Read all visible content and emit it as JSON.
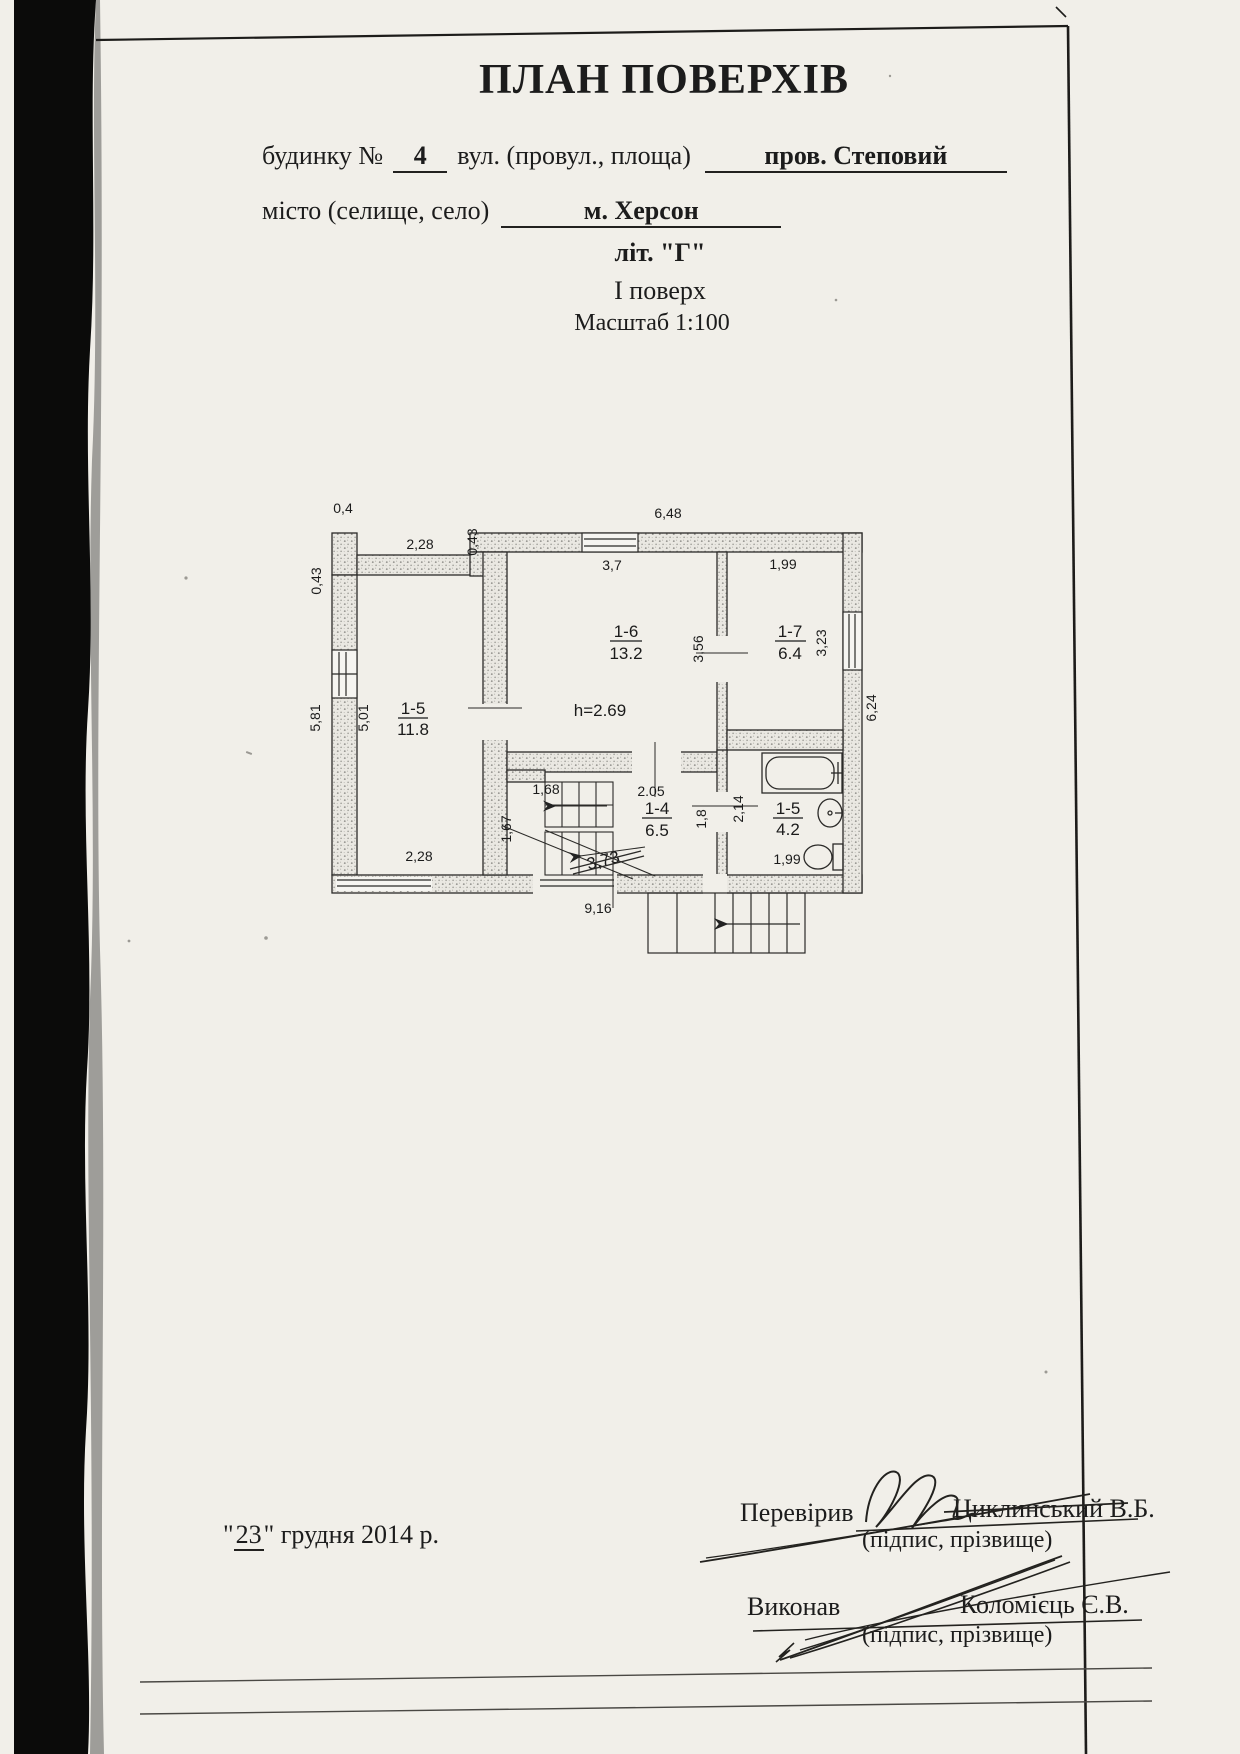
{
  "header": {
    "title": "ПЛАН ПОВЕРХІВ",
    "form_line1": {
      "label1": "будинку №",
      "value1": "4",
      "label2": "вул. (провул., площа)",
      "value2": "пров. Степовий"
    },
    "form_line2": {
      "label": "місто (селище, село)",
      "value": "м. Херсон"
    },
    "liter": "літ. \"Г\"",
    "floor_label": "І поверх",
    "scale_label": "Масштаб 1:100"
  },
  "plan": {
    "rooms": {
      "r15": {
        "id": "1-5",
        "area": "11.8"
      },
      "r16": {
        "id": "1-6",
        "area": "13.2"
      },
      "r17": {
        "id": "1-7",
        "area": "6.4"
      },
      "r14": {
        "id": "1-4",
        "area": "6.5"
      },
      "r15b": {
        "id": "1-5",
        "area": "4.2"
      }
    },
    "ceiling_height": "h=2.69",
    "stair_note_crossed": "3,73",
    "dims": {
      "pier_width": "0,4",
      "left_top_wall": "2,28",
      "top_offset": "0,43",
      "top_width": "6,48",
      "top_window": "3,7",
      "r17_width": "1,99",
      "left_wall_upper": "0,43",
      "left_outer": "5,81",
      "left_inner": "5,01",
      "r16_depth": "3,56",
      "r17_window": "3,23",
      "right_outer": "6,24",
      "r15_bottom": "2,28",
      "stair_width": "1,68",
      "stair_depth": "1,67",
      "hall_width": "2.05",
      "hall_depth": "1,8",
      "bath_depth": "2,14",
      "bath_width": "1,99",
      "bottom_width": "9,16"
    }
  },
  "footer": {
    "quote": "\"",
    "date_day": "23",
    "date_rest": " грудня 2014 р.",
    "checked_label": "Перевірив",
    "checked_name": "Циклинський В.Б.",
    "checked_caption": "(підпис, прізвище)",
    "made_label": "Виконав",
    "made_name": "Коломієць Є.В.",
    "made_caption": "(підпис, прізвище)"
  }
}
